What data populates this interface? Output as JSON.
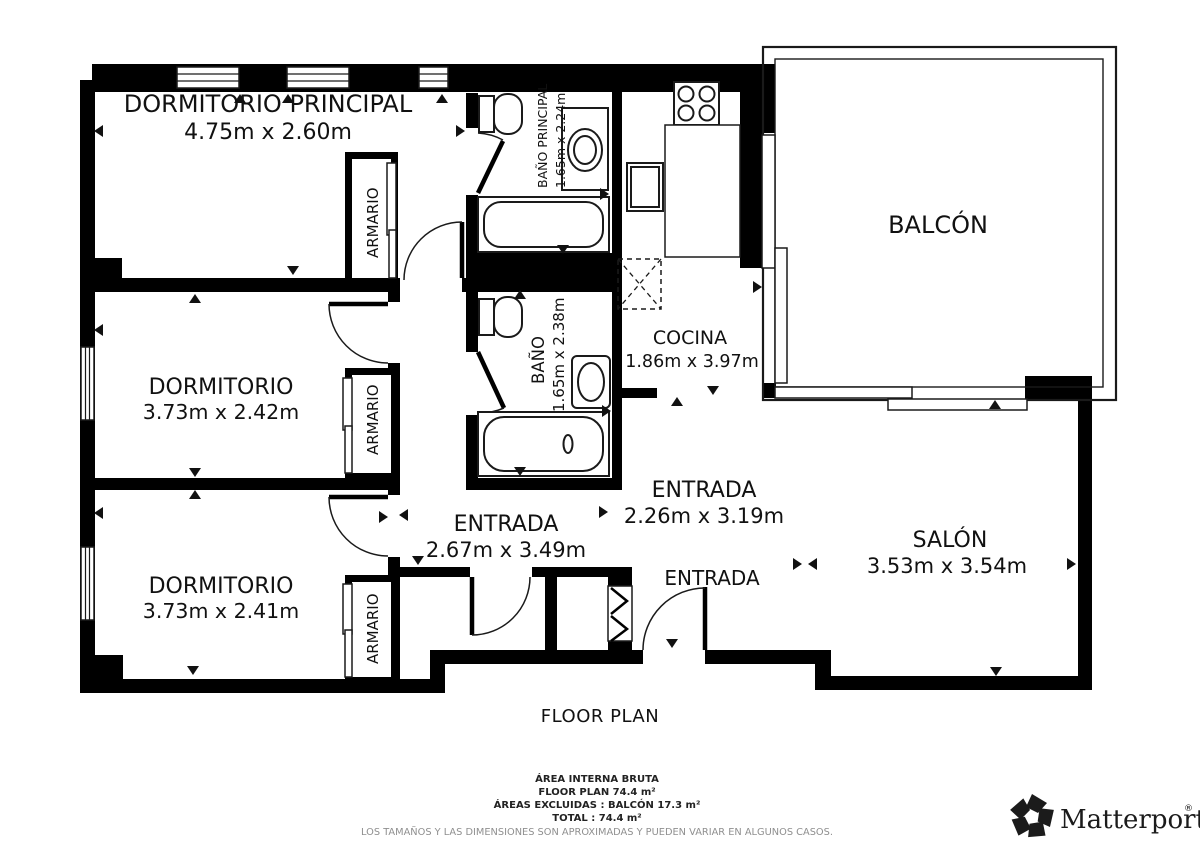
{
  "floor_plan": {
    "rooms": {
      "dormitorio_principal": {
        "name": "DORMITORIO PRINCIPAL",
        "dimensions": "4.75m x 2.60m"
      },
      "dormitorio_2": {
        "name": "DORMITORIO",
        "dimensions": "3.73m x 2.42m"
      },
      "dormitorio_3": {
        "name": "DORMITORIO",
        "dimensions": "3.73m x 2.41m"
      },
      "bano_principal": {
        "name": "BAÑO PRINCIPAL",
        "dimensions": "1.65m x 2.24m"
      },
      "bano": {
        "name": "BAÑO",
        "dimensions": "1.65m x 2.38m"
      },
      "cocina": {
        "name": "COCINA",
        "dimensions": "1.86m x 3.97m"
      },
      "balcon": {
        "name": "BALCÓN"
      },
      "salon": {
        "name": "SALÓN",
        "dimensions": "3.53m x 3.54m"
      },
      "entrada_pasillo": {
        "name": "ENTRADA",
        "dimensions": "2.67m x 3.49m"
      },
      "entrada_central": {
        "name": "ENTRADA",
        "dimensions": "2.26m x 3.19m"
      },
      "entrada_vestibulo": {
        "name": "ENTRADA"
      },
      "armario": {
        "name": "ARMARIO"
      }
    },
    "caption": "FLOOR PLAN",
    "summary": {
      "line1": "ÁREA INTERNA BRUTA",
      "line2": "FLOOR PLAN 74.4 m²",
      "line3": "ÁREAS EXCLUIDAS :  BALCÓN 17.3 m²",
      "line4": "TOTAL :  74.4 m²",
      "disclaimer": "LOS TAMAÑOS Y LAS DIMENSIONES SON APROXIMADAS Y PUEDEN VARIAR EN ALGUNOS CASOS."
    },
    "branding": {
      "logo_text": "Matterport",
      "registered_mark": "®"
    },
    "colors": {
      "walls": "#000000",
      "background": "#ffffff",
      "label_text": "#111111",
      "disclaimer": "#8f8f8f"
    }
  }
}
